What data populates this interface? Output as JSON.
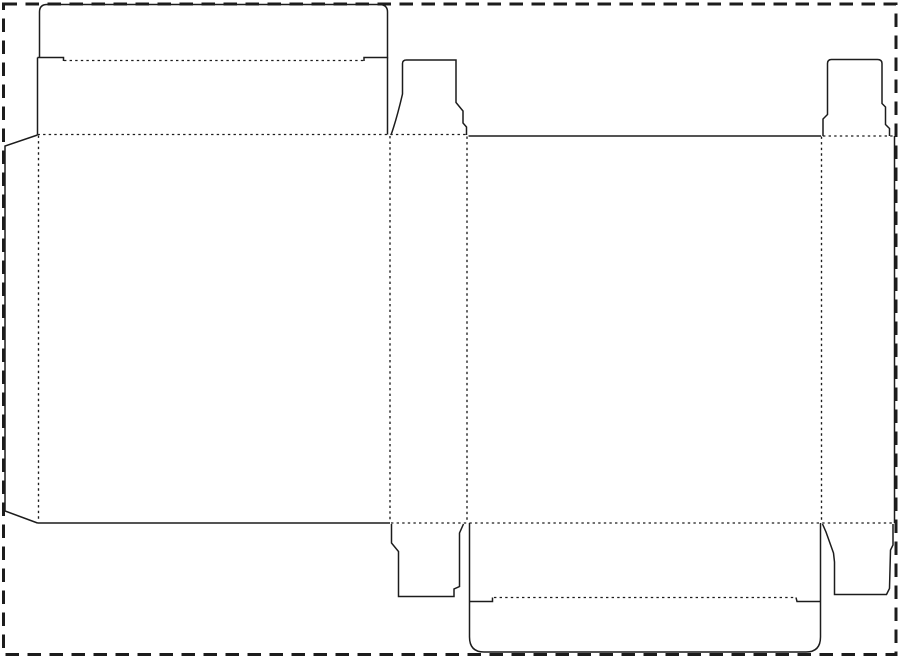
{
  "meta": {
    "description": "Die-cut packaging template (reverse tuck-end carton dieline) on a white page with dashed border",
    "canvas": {
      "width": 900,
      "height": 658
    }
  },
  "colors": {
    "background": "#ffffff",
    "line": "#1c1c1c"
  },
  "styles": {
    "cut": {
      "stroke_width": 1.5,
      "dash": ""
    },
    "fold": {
      "stroke_width": 1.35,
      "dash": "2.4 3.2"
    },
    "border": {
      "stroke_width": 3,
      "dash": "13.5 8.5"
    }
  },
  "border": {
    "x": 3.5,
    "y": 4,
    "width": 892.5,
    "height": 650.5
  },
  "paths": [
    {
      "name": "top-tuck-flap-outline",
      "type": "cut",
      "d": "M 63.5,61 L 63.5,57.5 L 37.5,57.5 M 39.5,57.5 L 39.5,12 Q 39.5,4.5 47,4.5 L 379,4.5 Q 387.5,4.5 387.5,12 L 387.5,57.5 L 364,57.5 L 364,61"
    },
    {
      "name": "top-lid-left-edge",
      "type": "cut",
      "d": "M 37.5,57.5 L 37.5,134.5"
    },
    {
      "name": "top-lid-right-edge",
      "type": "cut",
      "d": "M 387.5,57.5 L 387.5,134.5"
    },
    {
      "name": "glue-flap-outline",
      "type": "cut",
      "d": "M 37.5,135 L 5,146 L 5,511 L 37.5,523"
    },
    {
      "name": "front-panel-bottom-cut",
      "type": "cut",
      "d": "M 37.5,523 L 390,523"
    },
    {
      "name": "top-dust-flap-side1",
      "type": "cut",
      "d": "M 391,135 C 396,121 399,109 402.5,94 L 402.5,63.5 Q 402.5,60 406.5,60 L 456,60 L 456,102.5 L 463,111 L 463,123 L 466.5,127 L 466.5,135"
    },
    {
      "name": "back-panel-top-cut",
      "type": "cut",
      "d": "M 468.5,136 L 821,136"
    },
    {
      "name": "top-dust-flap-side2",
      "type": "cut",
      "d": "M 823,136 L 823,119 L 827.5,114.5 L 827.5,63.5 Q 827.5,59.5 831.5,59.5 L 877.5,59.5 Q 882,59.5 882,63.5 L 882,103.5 L 885.5,107 L 885.5,124.5 L 889.5,128.5 L 889.5,136"
    },
    {
      "name": "side-panel-right-cut",
      "type": "cut",
      "d": "M 894.5,136 L 894.5,523"
    },
    {
      "name": "bottom-lid-outline",
      "type": "cut",
      "d": "M 469.5,523 L 469.5,637 Q 469.5,652 484,652 L 806,652 Q 820.5,652 820.5,637 L 820.5,523"
    },
    {
      "name": "bottom-lid-left-shoulder",
      "type": "cut",
      "d": "M 469.5,601.5 L 492.5,601.5 L 492.5,597.5"
    },
    {
      "name": "bottom-lid-right-shoulder",
      "type": "cut",
      "d": "M 820.5,601.5 L 797,601.5 L 796,597.5"
    },
    {
      "name": "bottom-dust-flap-side1",
      "type": "cut",
      "d": "M 391.5,524 L 391.5,543 L 398.5,551.5 L 398.5,596.5 L 454,596.5 L 454,589 L 459.5,586.5 L 459.5,533 L 463.5,524"
    },
    {
      "name": "bottom-dust-flap-side2",
      "type": "cut",
      "d": "M 822.5,524 L 826,532 L 833.5,553 L 834.5,562 L 834.5,594.5 L 886.5,594.5 L 889.5,588.5 L 890.5,550 L 893,545 L 893,524"
    },
    {
      "name": "top-tuck-fold",
      "type": "fold",
      "d": "M 64,60.5 L 363.5,60.5"
    },
    {
      "name": "top-horizontal-fold",
      "type": "fold",
      "d": "M 37.5,134.5 L 466.5,134.5"
    },
    {
      "name": "top-right-fold",
      "type": "fold",
      "d": "M 823,136 L 894,136"
    },
    {
      "name": "bottom-horizontal-fold",
      "type": "fold",
      "d": "M 391,523 L 893,523"
    },
    {
      "name": "bottom-tuck-fold",
      "type": "fold",
      "d": "M 494,597.5 L 795,597.5"
    },
    {
      "name": "fold-vertical-glue-flap",
      "type": "fold",
      "d": "M 38.5,135.5 L 38.5,520"
    },
    {
      "name": "fold-vertical-panel1-panel2",
      "type": "fold",
      "d": "M 390,136 L 390,521.5"
    },
    {
      "name": "fold-vertical-panel2-panel3",
      "type": "fold",
      "d": "M 467,136.5 L 467,521.5"
    },
    {
      "name": "fold-vertical-panel3-panel4",
      "type": "fold",
      "d": "M 821.5,136.5 L 821.5,521.5"
    }
  ]
}
